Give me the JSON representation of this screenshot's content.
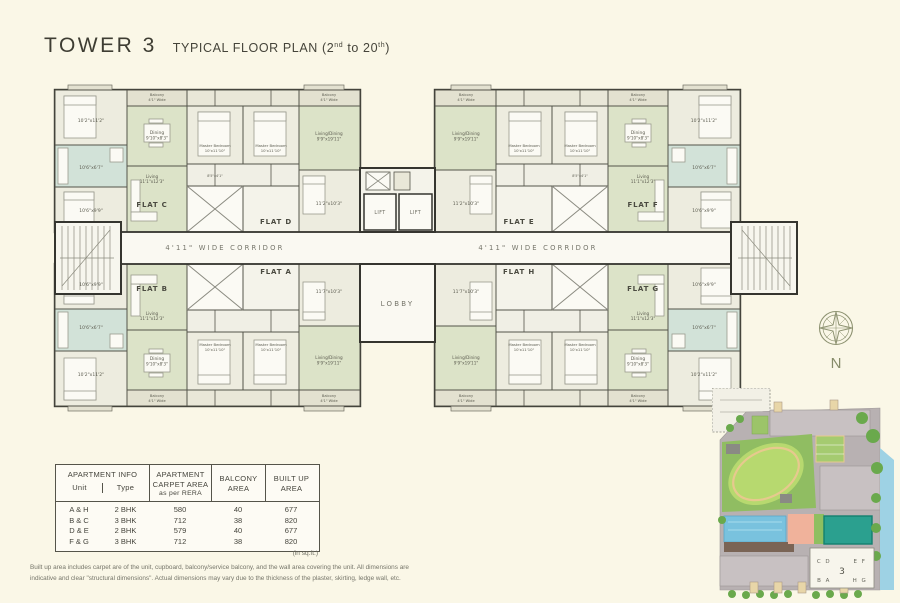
{
  "header": {
    "title": "TOWER 3",
    "subtitle": {
      "p1": "TYPICAL FLOOR PLAN (2",
      "s1": "nd",
      "p2": " to 20",
      "s2": "th",
      "p3": ")"
    }
  },
  "floorplan": {
    "corridor": "4'11\" WIDE CORRIDOR",
    "lift": "LIFT",
    "lobby": "LOBBY",
    "compass": "N",
    "flats": {
      "a": "FLAT A",
      "b": "FLAT B",
      "c": "FLAT C",
      "d": "FLAT D",
      "e": "FLAT E",
      "f": "FLAT F",
      "g": "FLAT G",
      "h": "FLAT H"
    },
    "rooms": {
      "master_bedroom": {
        "name": "Master Bedroom",
        "dim": "10'x11'10\""
      },
      "living_dining": {
        "name": "Living/Dining",
        "dim": "9'9\"x19'11\""
      },
      "dining": {
        "name": "Dining",
        "dim": "9'10\"x8'3\""
      },
      "living": {
        "name": "Living",
        "dim": "11'1\"x12'3\""
      },
      "balcony": {
        "name": "Balcony",
        "dim": "4'1\" Wide"
      },
      "kitchen": {
        "dim": "10'6\"x6'7\""
      },
      "bedroom1": {
        "dim": "10'2\"x11'2\""
      },
      "bedroom2": {
        "dim": "10'6\"x9'9\""
      },
      "bedroom3": {
        "dim": "11'2\"x10'3\""
      },
      "bedroom4": {
        "dim": "11'7\"x10'3\""
      },
      "toilet": {
        "dim": "8'5\"x4'1\""
      }
    }
  },
  "table": {
    "group": "APARTMENT INFO",
    "unit_col": "Unit",
    "type_col": "Type",
    "carpet": [
      "APARTMENT",
      "CARPET AREA",
      "as per RERA"
    ],
    "balcony": [
      "BALCONY",
      "AREA"
    ],
    "built": [
      "BUILT UP",
      "AREA"
    ],
    "rows": [
      {
        "unit": "A & H",
        "type": "2 BHK",
        "carpet": "580",
        "balcony": "40",
        "built": "677"
      },
      {
        "unit": "B & C",
        "type": "3 BHK",
        "carpet": "712",
        "balcony": "38",
        "built": "820"
      },
      {
        "unit": "D & E",
        "type": "2 BHK",
        "carpet": "579",
        "balcony": "40",
        "built": "677"
      },
      {
        "unit": "F & G",
        "type": "3 BHK",
        "carpet": "712",
        "balcony": "38",
        "built": "820"
      }
    ],
    "note": "(in sq.ft.)"
  },
  "footnote": {
    "line1": "Built up area includes carpet are of the unit, cupboard, balcony/service balcony, and the wall area covering the unit. All dimensions are",
    "line2": "indicative and clear \"structural dimensions\". Actual dimensions may vary due to the thickness of the plaster, skirting, ledge wall, etc."
  },
  "siteplan": {
    "cd": "C D",
    "ef": "E F",
    "tower": "3",
    "ba": "B A",
    "hg": "H G"
  },
  "colors": {
    "background": "#faf7e7",
    "wall": "#35352f",
    "room_base": "#f1efe2",
    "living_green": "#dce3c8",
    "kitchen_teal": "#d2e2d8",
    "balcony_grey": "#e3e1d0",
    "corridor_white": "#faf9f2",
    "lawn_green": "#b7d96f",
    "pool_blue": "#79c2de",
    "court_teal": "#2ba08f",
    "site_grey": "#b8b1b2"
  }
}
